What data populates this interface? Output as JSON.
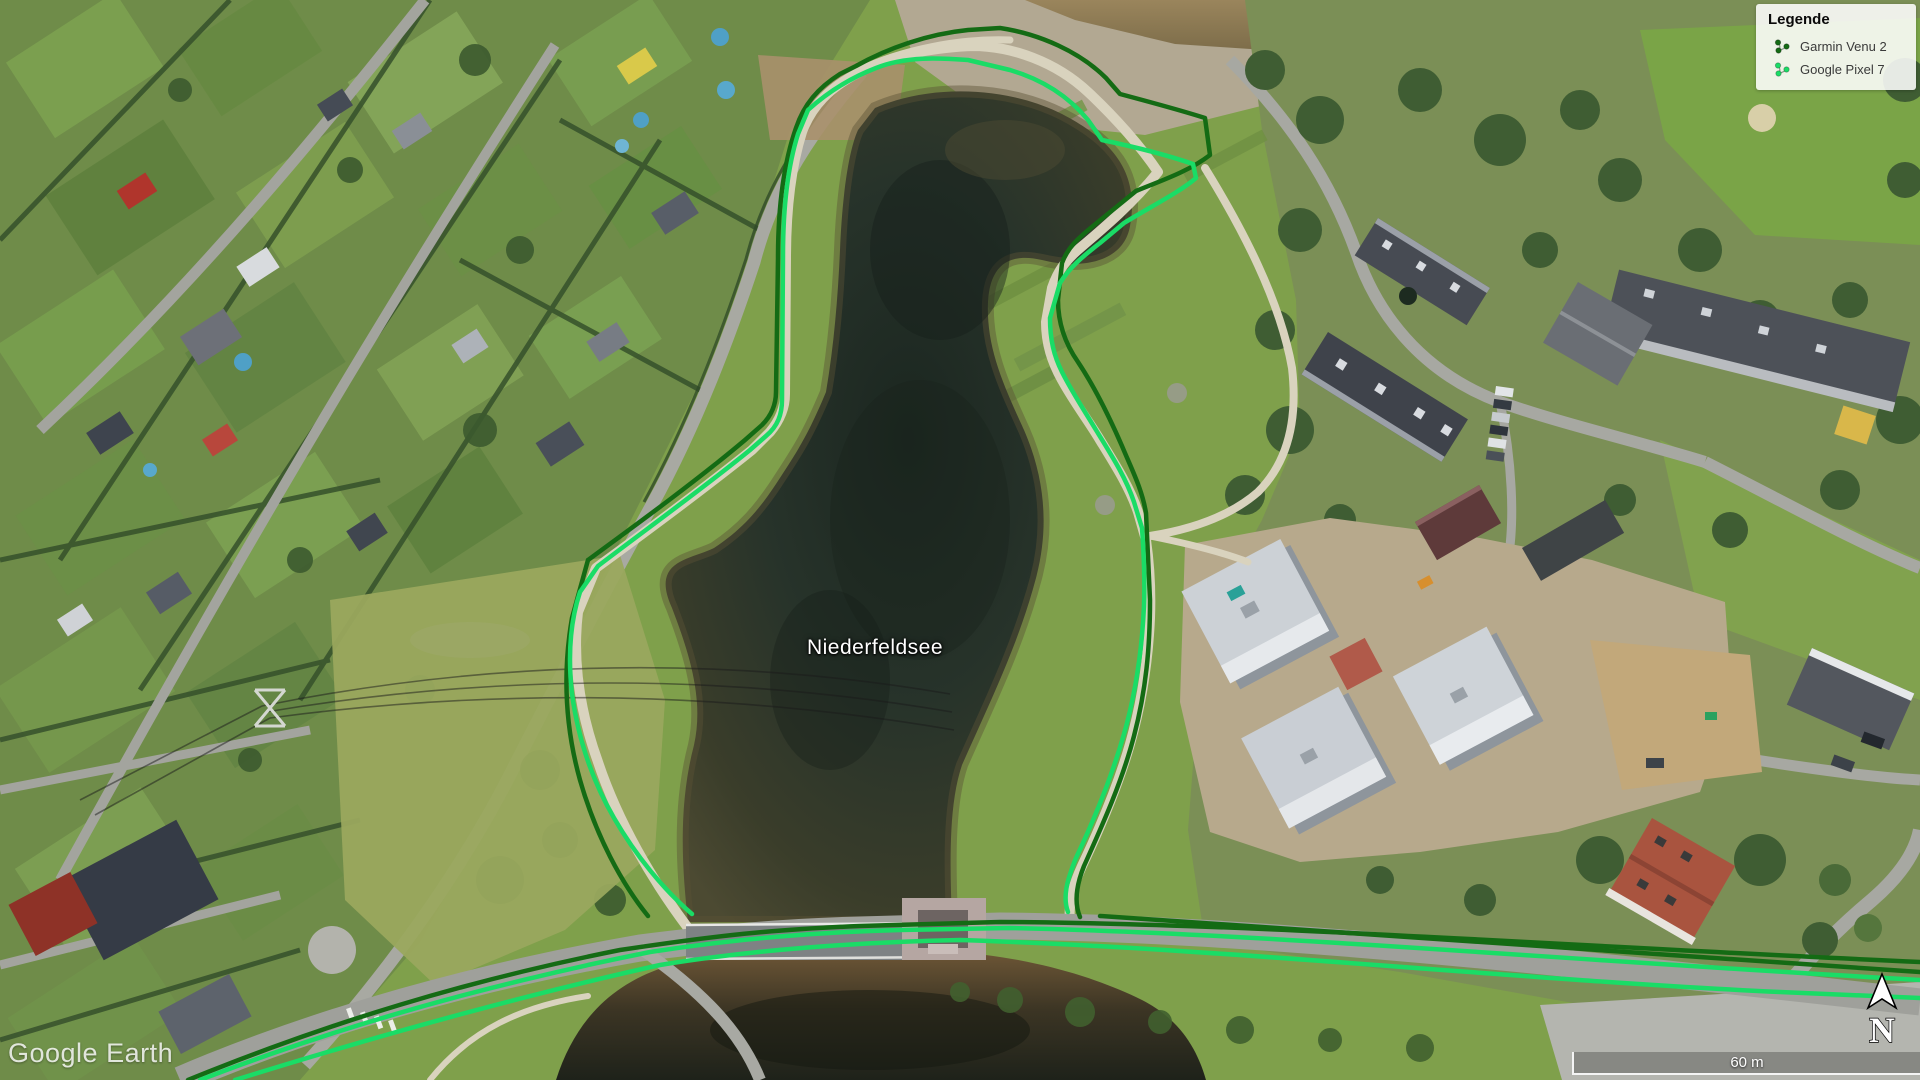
{
  "watermark": {
    "text": "Google Earth"
  },
  "map": {
    "lake_label": "Niederfeldsee"
  },
  "legend": {
    "title": "Legende",
    "items": [
      {
        "label": "Garmin Venu 2",
        "color": "#146b14"
      },
      {
        "label": "Google Pixel 7",
        "color": "#1adc66"
      }
    ]
  },
  "scalebar": {
    "label": "60 m"
  },
  "compass": {
    "label": "N"
  }
}
